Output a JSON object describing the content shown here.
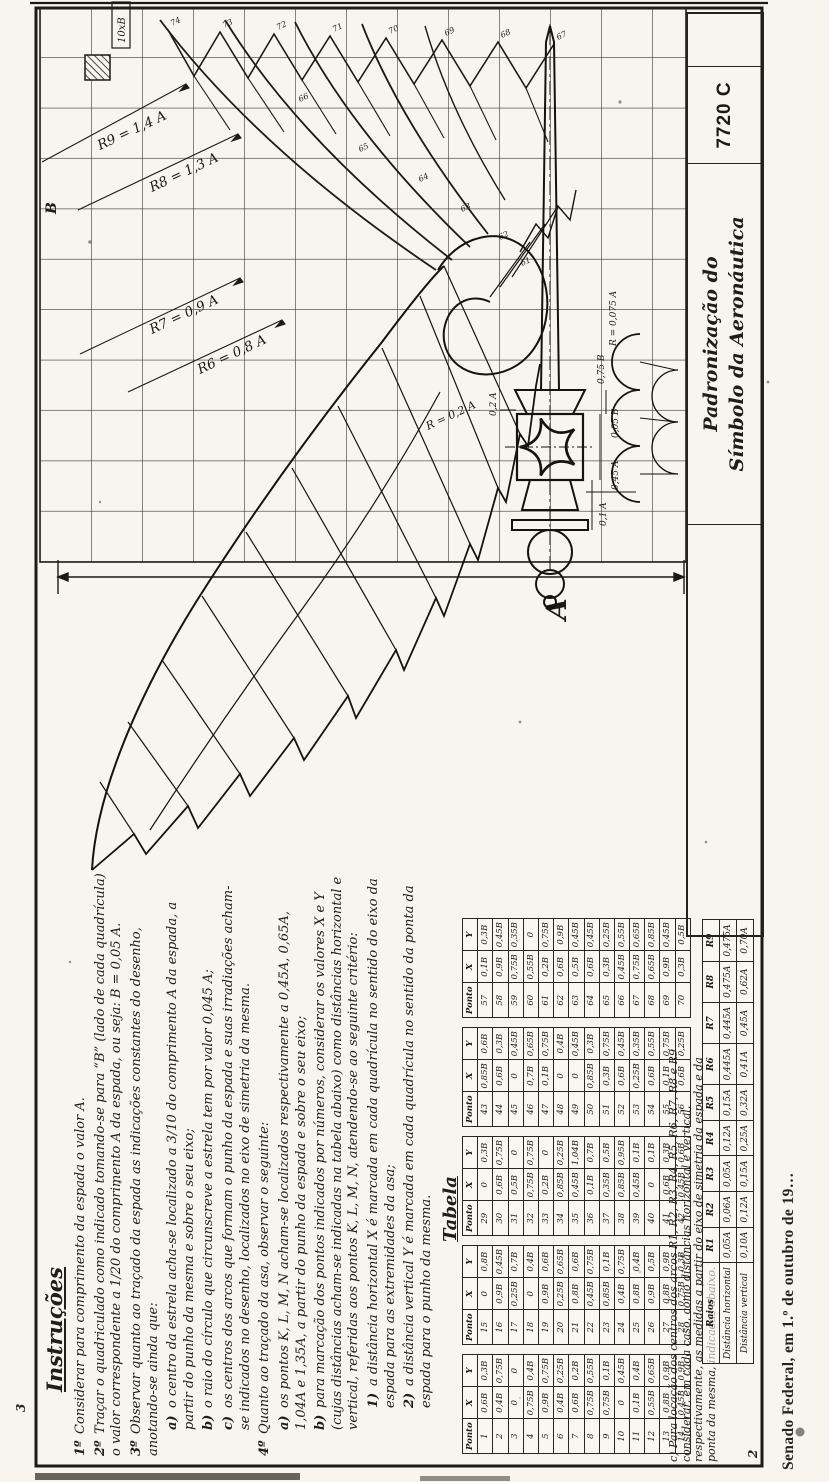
{
  "title_block": {
    "line1": "Padronização do",
    "line2": "Símbolo da Aeronáutica",
    "code": "7720 C"
  },
  "caption": "Senado Federal, em 1.º de outubro de 19…",
  "instructions": {
    "heading": "Instruções",
    "items": [
      {
        "num": "1º",
        "text": "Considerar para comprimento da espada o valor A."
      },
      {
        "num": "2º",
        "text": "Traçar o quadriculado como indicado tomando-se para “B” (lado de cada quadrícula) o valor correspondente a 1/20 do comprimento A da espada, ou seja: B = 0,05 A."
      },
      {
        "num": "3º",
        "text": "Observar quanto ao traçado da espada as indicações constantes do desenho, anotando-se ainda que:"
      },
      {
        "num": "a)",
        "text": "o centro da estrela acha-se localizado a 3/10 do comprimento A da espada, a partir do punho da mesma e sobre o seu eixo;"
      },
      {
        "num": "b)",
        "text": "o raio do círculo que circunscreve a estrela tem por valor 0,045 A;"
      },
      {
        "num": "c)",
        "text": "os centros dos arcos que formam o punho da espada e suas irradiações acham-se indicados no desenho, localizados no eixo de simetria da mesma."
      },
      {
        "num": "4º",
        "text": "Quanto ao traçado da asa, observar o seguinte:"
      },
      {
        "num": "a)",
        "text": "os pontos K, L, M, N acham-se localizados respectivamente a 0,45A, 0,65A, 1,04A e 1,35A, a partir do punho da espada e sobre o seu eixo;"
      },
      {
        "num": "b)",
        "text": "para marcação dos pontos indicados por números, considerar os valores X e Y (cujas distâncias acham-se indicadas na tabela abaixo) como distâncias horizontal e vertical, referidas aos pontos K, L, M, N, atendendo-se ao seguinte critério:"
      },
      {
        "num": "1)",
        "text": "a distância horizontal X é marcada em cada quadrícula no sentido do eixo da espada para as extremidades da asa;"
      },
      {
        "num": "2)",
        "text": "a distância vertical Y é marcada em cada quadrícula no sentido da ponta da espada para o punho da mesma."
      }
    ]
  },
  "tabela": {
    "heading": "Tabela",
    "groups": [
      {
        "headers": [
          "Ponto",
          "X",
          "Y"
        ],
        "rows": [
          [
            "1",
            "0,6B",
            "0,3B"
          ],
          [
            "2",
            "0,4B",
            "0,75B"
          ],
          [
            "3",
            "0",
            "0"
          ],
          [
            "4",
            "0,75B",
            "0,4B"
          ],
          [
            "5",
            "0,9B",
            "0,75B"
          ],
          [
            "6",
            "0,4B",
            "0,25B"
          ],
          [
            "7",
            "0,6B",
            "0,2B"
          ],
          [
            "8",
            "0,75B",
            "0,55B"
          ],
          [
            "9",
            "0,75B",
            "0,1B"
          ],
          [
            "10",
            "0",
            "0,45B"
          ],
          [
            "11",
            "0,1B",
            "0,4B"
          ],
          [
            "12",
            "0,55B",
            "0,65B"
          ],
          [
            "13",
            "0,8B",
            "0,9B"
          ],
          [
            "14",
            "0,45B",
            "0,9B"
          ]
        ]
      },
      {
        "headers": [
          "Ponto",
          "X",
          "Y"
        ],
        "rows": [
          [
            "15",
            "0",
            "0,8B"
          ],
          [
            "16",
            "0,9B",
            "0,45B"
          ],
          [
            "17",
            "0,25B",
            "0,7B"
          ],
          [
            "18",
            "0",
            "0,4B"
          ],
          [
            "19",
            "0,9B",
            "0,6B"
          ],
          [
            "20",
            "0,25B",
            "0,65B"
          ],
          [
            "21",
            "0,8B",
            "0,6B"
          ],
          [
            "22",
            "0,45B",
            "0,75B"
          ],
          [
            "23",
            "0,85B",
            "0,1B"
          ],
          [
            "24",
            "0,4B",
            "0,75B"
          ],
          [
            "25",
            "0,8B",
            "0,4B"
          ],
          [
            "26",
            "0,9B",
            "0,5B"
          ],
          [
            "27",
            "0,8B",
            "0,9B"
          ],
          [
            "28",
            "0,75B",
            "0,3B"
          ]
        ]
      },
      {
        "headers": [
          "Ponto",
          "X",
          "Y"
        ],
        "rows": [
          [
            "29",
            "0",
            "0,3B"
          ],
          [
            "30",
            "0,6B",
            "0,75B"
          ],
          [
            "31",
            "0,5B",
            "0"
          ],
          [
            "32",
            "0,75B",
            "0,75B"
          ],
          [
            "33",
            "0,2B",
            "0"
          ],
          [
            "34",
            "0,85B",
            "0,25B"
          ],
          [
            "35",
            "0,45B",
            "1,04B"
          ],
          [
            "36",
            "0,1B",
            "0,7B"
          ],
          [
            "37",
            "0,35B",
            "0,5B"
          ],
          [
            "38",
            "0,85B",
            "0,95B"
          ],
          [
            "39",
            "0,45B",
            "0,1B"
          ],
          [
            "40",
            "0",
            "0,1B"
          ],
          [
            "41",
            "0,6B",
            "0,3B"
          ],
          [
            "42",
            "0,45B",
            "0,6B"
          ]
        ]
      },
      {
        "headers": [
          "Ponto",
          "X",
          "Y"
        ],
        "rows": [
          [
            "43",
            "0,85B",
            "0,6B"
          ],
          [
            "44",
            "0,6B",
            "0,3B"
          ],
          [
            "45",
            "0",
            "0,45B"
          ],
          [
            "46",
            "0,7B",
            "0,65B"
          ],
          [
            "47",
            "0,1B",
            "0,75B"
          ],
          [
            "48",
            "0",
            "0,4B"
          ],
          [
            "49",
            "0",
            "0,45B"
          ],
          [
            "50",
            "0,85B",
            "0,3B"
          ],
          [
            "51",
            "0,3B",
            "0,75B"
          ],
          [
            "52",
            "0,6B",
            "0,45B"
          ],
          [
            "53",
            "0,25B",
            "0,35B"
          ],
          [
            "54",
            "0,6B",
            "0,55B"
          ],
          [
            "55",
            "0,1B",
            "0,75B"
          ],
          [
            "56",
            "0,6B",
            "0,25B"
          ]
        ]
      },
      {
        "headers": [
          "Ponto",
          "X",
          "Y"
        ],
        "rows": [
          [
            "57",
            "0,1B",
            "0,3B"
          ],
          [
            "58",
            "0,9B",
            "0,45B"
          ],
          [
            "59",
            "0,75B",
            "0,35B"
          ],
          [
            "60",
            "0,55B",
            "0"
          ],
          [
            "61",
            "0,2B",
            "0,75B"
          ],
          [
            "62",
            "0,6B",
            "0,9B"
          ],
          [
            "63",
            "0,5B",
            "0,45B"
          ],
          [
            "64",
            "0,6B",
            "0,45B"
          ],
          [
            "65",
            "0,3B",
            "0,25B"
          ],
          [
            "66",
            "0,45B",
            "0,55B"
          ],
          [
            "67",
            "0,75B",
            "0,65B"
          ],
          [
            "68",
            "0,65B",
            "0,85B"
          ],
          [
            "69",
            "0,9B",
            "0,45B"
          ],
          [
            "70",
            "0,3B",
            "0,5B"
          ]
        ]
      }
    ]
  },
  "note_c": "c) Para locação dos centros dos arcos R1, R2, R3, R4, R5, R6, R7, R8 e R9 considerar, em cada caso, como distâncias horizontal e vertical, respectivamente, as medidas a partir do eixo de simetria da espada e da ponta da mesma, indicadas abaixo.",
  "raios": {
    "headers": [
      "Raios",
      "R1",
      "R2",
      "R3",
      "R4",
      "R5",
      "R6",
      "R7",
      "R8",
      "R9"
    ],
    "rows": [
      [
        "Distância horizontal",
        "0,05A",
        "0,06A",
        "0,05A",
        "0,12A",
        "0,15A",
        "0,445A",
        "0,445A",
        "0,475A",
        "0,475A"
      ],
      [
        "Distância vertical",
        "0,10A",
        "0,12A",
        "0,15A",
        "0,25A",
        "0,32A",
        "0,41A",
        "0,45A",
        "0,62A",
        "0,70A"
      ]
    ]
  },
  "drawing": {
    "radius_labels": [
      "R9 = 1,4 A",
      "R8 = 1,3 A",
      "R7 = 0,9 A",
      "R6 = 0,8 A"
    ],
    "scroll_radius_label": "R = 0,2 A",
    "dim_a_label": "A",
    "grid_b_label": "B",
    "ten_b_label": "10xB",
    "hilt_dims": [
      "0,2 A",
      "0,1 A",
      "0,45 A",
      "0,05 B",
      "0,75 B",
      "R = 0,075 A"
    ],
    "point_numbers": [
      "74",
      "73",
      "72",
      "71",
      "70",
      "69",
      "68",
      "67",
      "66",
      "65",
      "64",
      "63",
      "62",
      "61"
    ]
  },
  "marks": {
    "left": "3",
    "right": "2"
  }
}
